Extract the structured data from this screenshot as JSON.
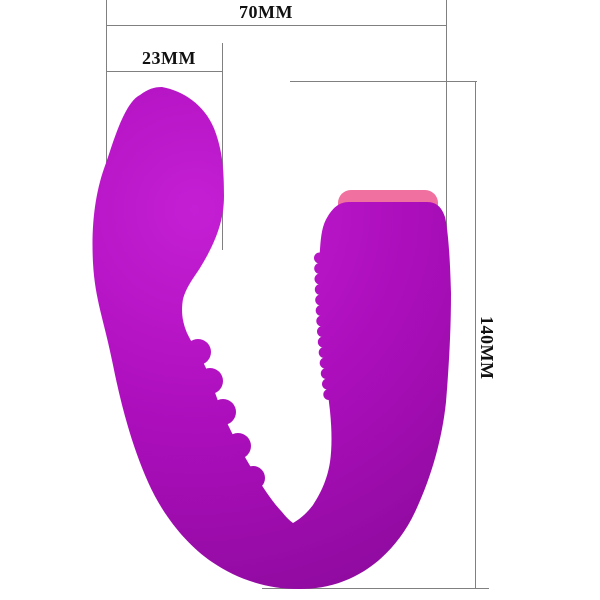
{
  "labels": {
    "width_total": "70MM",
    "width_head": "23MM",
    "height_total": "140MM"
  },
  "colors": {
    "background": "#ffffff",
    "dimension_line": "#808080",
    "label_text": "#111111",
    "body_highlight": "#c51fd4",
    "body_mid": "#ac0ebc",
    "body_shadow": "#8c0a9c",
    "cap_pink": "#f0709f"
  }
}
